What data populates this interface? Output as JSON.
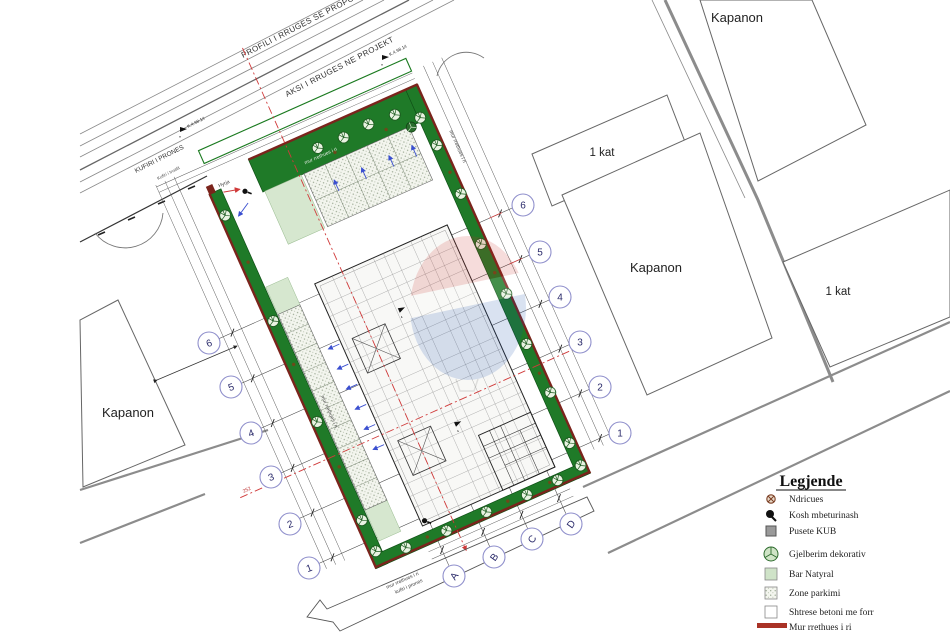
{
  "plan": {
    "buildings": {
      "top_right": "Kapanon",
      "middle_right": "Kapanon",
      "left": "Kapanon",
      "one_kat_top": "1 kat",
      "one_kat_bottom": "1 kat"
    },
    "roads": {
      "profile": "PROFILI I RRUGES SE PROPOZUAR",
      "axis": "AKSI I RRUGES NE PROJEKT",
      "boundary": "KUFIRI I PRONES",
      "boundary_small": "Kufiri i trualit",
      "plot_boundary": "kufiri i prones",
      "wall_label": "mur rrethues i ri"
    },
    "annotations": {
      "entrance": "Hyrja",
      "dim": "252",
      "marker": "K.4.98.14"
    },
    "axes": {
      "numbers": [
        "1",
        "2",
        "3",
        "4",
        "5",
        "6"
      ],
      "letters": [
        "A",
        "B",
        "C",
        "D"
      ]
    }
  },
  "legend": {
    "title": "Legjende",
    "items": [
      {
        "icon": "light-icon",
        "label": "Ndricues"
      },
      {
        "icon": "trash-icon",
        "label": "Kosh mbeturinash"
      },
      {
        "icon": "manhole-icon",
        "label": "Pusete KUB"
      },
      {
        "icon": "tree-icon",
        "label": "Gjelberim dekorativ"
      },
      {
        "icon": "natural-bar-icon",
        "label": "Bar Natyral"
      },
      {
        "icon": "parking-zone-icon",
        "label": "Zone parkimi"
      },
      {
        "icon": "concrete-icon",
        "label": "Shtrese betoni me forr"
      },
      {
        "icon": "wall-icon",
        "label": "Mur rrethues i ri"
      }
    ]
  },
  "colors": {
    "strip_green": "#1f7a28",
    "wall_red": "#7b241c",
    "axis_red": "#d03a3a",
    "road_gray": "#8c8c8c",
    "bubble_stroke": "#9090cc",
    "arrow_blue": "#3a4fd0",
    "legend_wall": "#a93226"
  }
}
